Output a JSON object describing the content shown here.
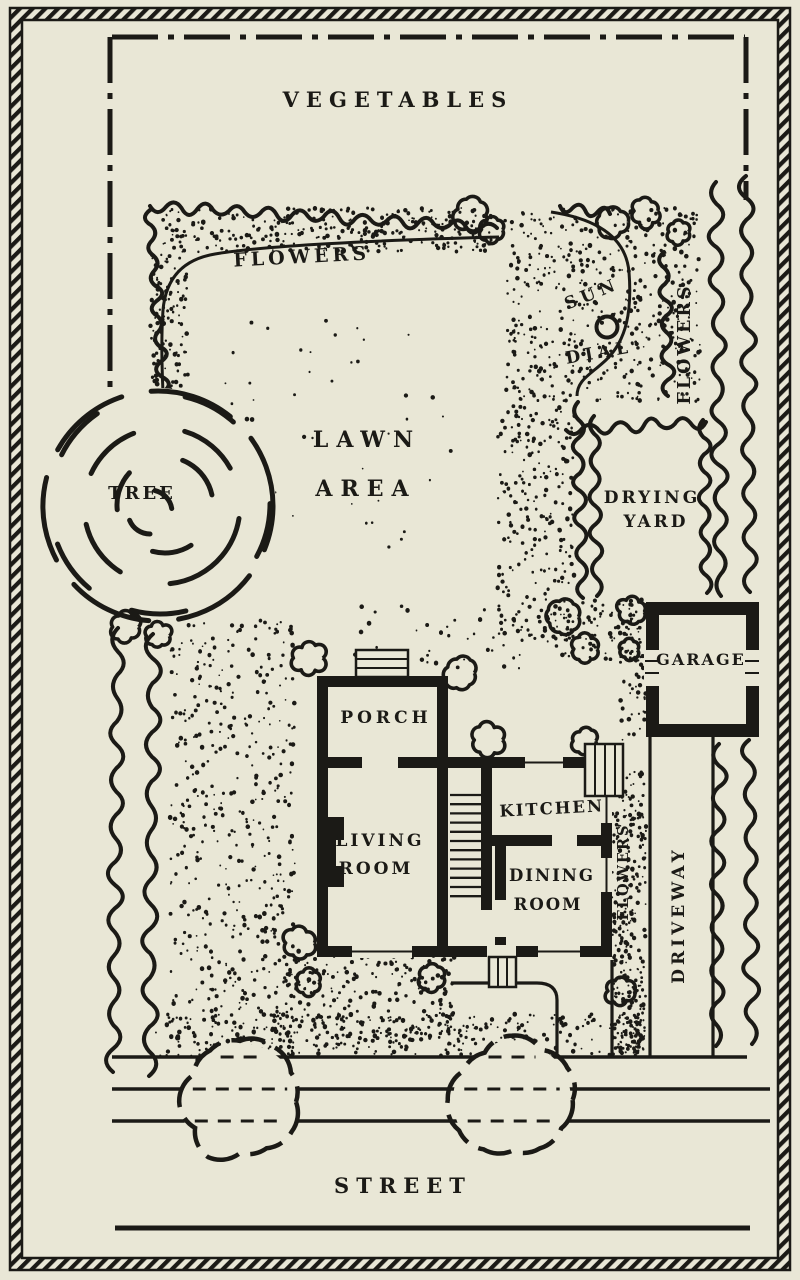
{
  "labels": {
    "vegetables": "VEGETABLES",
    "flowers_border": "FLOWERS",
    "sun": "SUN",
    "dial": "DIAL",
    "flowers_right": "FLOWERS",
    "lawn_line1": "LAWN",
    "lawn_line2": "AREA",
    "tree": "TREE",
    "drying_line1": "DRYING",
    "drying_line2": "YARD",
    "garage": "GARAGE",
    "porch": "PORCH",
    "living_line1": "LIVING",
    "living_line2": "ROOM",
    "kitchen": "KITCHEN",
    "dining_line1": "DINING",
    "dining_line2": "ROOM",
    "flowers_house_strip": "FLOWERS",
    "driveway": "DRIVEWAY",
    "street": "STREET"
  },
  "colors": {
    "paper": "#e9e7d6",
    "ink": "#1b1a16"
  }
}
